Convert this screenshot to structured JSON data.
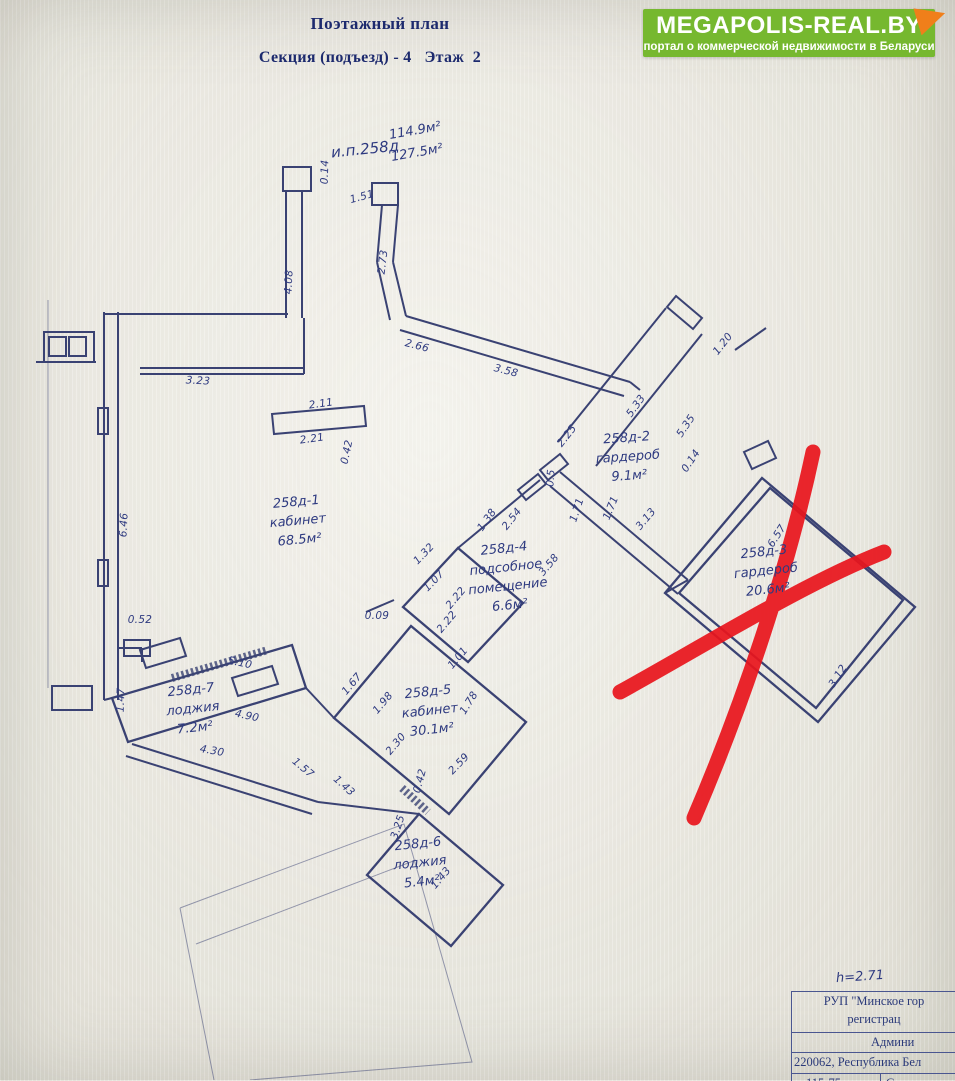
{
  "header": {
    "title": "Поэтажный план",
    "subtitle": "Секция (подъезд) - 4   Этаж  2"
  },
  "logo": {
    "name": "MEGAPOLIS-REAL.BY",
    "tagline": "портал о коммерческой недвижимости в Беларуси",
    "bg_color": "#76b82f",
    "corner_color": "#f07f1a"
  },
  "plan": {
    "line_color": "#3a4273",
    "ink_color": "#2e3a80",
    "cross_color": "#e8161d",
    "annotations": [
      {
        "text": "и.п.258д",
        "x": 365,
        "y": 149,
        "r": -6,
        "size": 15
      },
      {
        "text": "114.9м²",
        "x": 415,
        "y": 131,
        "r": -10,
        "size": 13
      },
      {
        "text": "127.5м²",
        "x": 417,
        "y": 153,
        "r": -10,
        "size": 13
      },
      {
        "text": "h=2.71",
        "x": 860,
        "y": 977,
        "r": -4,
        "size": 13
      }
    ],
    "rooms": [
      {
        "lines": [
          "258д-1",
          "кабинет",
          "68.5м²"
        ],
        "x": 298,
        "y": 522,
        "r": -5
      },
      {
        "lines": [
          "258д-2",
          "гардероб",
          "9.1м²"
        ],
        "x": 628,
        "y": 458,
        "r": -4
      },
      {
        "lines": [
          "258д-3",
          "гардероб",
          "20.6м²"
        ],
        "x": 766,
        "y": 572,
        "r": -6
      },
      {
        "lines": [
          "258д-4",
          "подсобное",
          "помещение",
          "6.6м²"
        ],
        "x": 507,
        "y": 578,
        "r": -6
      },
      {
        "lines": [
          "258д-5",
          "кабинет",
          "30.1м²"
        ],
        "x": 430,
        "y": 712,
        "r": -6
      },
      {
        "lines": [
          "258д-6",
          "лоджия",
          "5.4м²"
        ],
        "x": 420,
        "y": 864,
        "r": -6
      },
      {
        "lines": [
          "258д-7",
          "лоджия",
          "7.2м²"
        ],
        "x": 193,
        "y": 710,
        "r": -6
      }
    ],
    "dimensions": [
      {
        "v": "0.14",
        "x": 325,
        "y": 172,
        "r": -88
      },
      {
        "v": "1.51",
        "x": 362,
        "y": 197,
        "r": -15
      },
      {
        "v": "4.08",
        "x": 289,
        "y": 282,
        "r": -87
      },
      {
        "v": "2.73",
        "x": 383,
        "y": 262,
        "r": -83
      },
      {
        "v": "2.66",
        "x": 417,
        "y": 346,
        "r": 14
      },
      {
        "v": "3.58",
        "x": 506,
        "y": 371,
        "r": 14
      },
      {
        "v": "3.23",
        "x": 198,
        "y": 381,
        "r": 3
      },
      {
        "v": "2.11",
        "x": 321,
        "y": 404,
        "r": -8
      },
      {
        "v": "2.21",
        "x": 312,
        "y": 439,
        "r": -8
      },
      {
        "v": "0.42",
        "x": 347,
        "y": 452,
        "r": -78
      },
      {
        "v": "1.20",
        "x": 723,
        "y": 344,
        "r": -52
      },
      {
        "v": "5.33",
        "x": 636,
        "y": 406,
        "r": -54
      },
      {
        "v": "5.35",
        "x": 686,
        "y": 426,
        "r": -56
      },
      {
        "v": "0.14",
        "x": 691,
        "y": 461,
        "r": -56
      },
      {
        "v": "2.25",
        "x": 567,
        "y": 436,
        "r": -52
      },
      {
        "v": "0.5",
        "x": 551,
        "y": 478,
        "r": -85
      },
      {
        "v": "1.38",
        "x": 487,
        "y": 520,
        "r": -54
      },
      {
        "v": "2.54",
        "x": 512,
        "y": 519,
        "r": -52
      },
      {
        "v": "1.71",
        "x": 577,
        "y": 510,
        "r": -72
      },
      {
        "v": "1.71",
        "x": 611,
        "y": 508,
        "r": -68
      },
      {
        "v": "3.13",
        "x": 646,
        "y": 519,
        "r": -50
      },
      {
        "v": "6.57",
        "x": 777,
        "y": 536,
        "r": -57
      },
      {
        "v": "3.12",
        "x": 838,
        "y": 676,
        "r": -57
      },
      {
        "v": "1.32",
        "x": 424,
        "y": 554,
        "r": -46
      },
      {
        "v": "1.07",
        "x": 434,
        "y": 581,
        "r": -46
      },
      {
        "v": "2.22",
        "x": 456,
        "y": 598,
        "r": -50
      },
      {
        "v": "2.22",
        "x": 447,
        "y": 622,
        "r": -50
      },
      {
        "v": "0.09",
        "x": 377,
        "y": 616,
        "r": 0
      },
      {
        "v": "3.58",
        "x": 549,
        "y": 565,
        "r": -50
      },
      {
        "v": "1.01",
        "x": 458,
        "y": 658,
        "r": -50
      },
      {
        "v": "1.78",
        "x": 469,
        "y": 703,
        "r": -58
      },
      {
        "v": "6.46",
        "x": 124,
        "y": 525,
        "r": -87
      },
      {
        "v": "0.52",
        "x": 140,
        "y": 620,
        "r": 0
      },
      {
        "v": "1.47",
        "x": 121,
        "y": 700,
        "r": -88
      },
      {
        "v": "5.10",
        "x": 240,
        "y": 663,
        "r": 12
      },
      {
        "v": "4.90",
        "x": 247,
        "y": 716,
        "r": 12
      },
      {
        "v": "4.30",
        "x": 212,
        "y": 751,
        "r": 10
      },
      {
        "v": "1.57",
        "x": 303,
        "y": 768,
        "r": 40
      },
      {
        "v": "1.43",
        "x": 344,
        "y": 786,
        "r": 42
      },
      {
        "v": "1.67",
        "x": 352,
        "y": 684,
        "r": -50
      },
      {
        "v": "1.98",
        "x": 383,
        "y": 703,
        "r": -50
      },
      {
        "v": "2.30",
        "x": 396,
        "y": 744,
        "r": -50
      },
      {
        "v": "0.42",
        "x": 420,
        "y": 781,
        "r": -75
      },
      {
        "v": "2.59",
        "x": 459,
        "y": 764,
        "r": -46
      },
      {
        "v": "3.25",
        "x": 398,
        "y": 827,
        "r": -72
      },
      {
        "v": "1.43",
        "x": 441,
        "y": 878,
        "r": -50
      }
    ]
  },
  "stamp_table": {
    "rows": [
      {
        "lines": [
          "РУП \"Минское гор",
          "регистрац"
        ],
        "align": "center",
        "h": 41,
        "pad_left": 0
      },
      {
        "lines": [
          "Админи"
        ],
        "align": "left",
        "h": 20,
        "pad_left": 79
      },
      {
        "lines": [
          "220062, Республика Бел"
        ],
        "align": "left",
        "h": 21,
        "pad_left": 2
      },
      {
        "lines": [
          "115-75"
        ],
        "align": "left",
        "h": 14,
        "pad_left": 14,
        "cell2": "С"
      }
    ]
  }
}
